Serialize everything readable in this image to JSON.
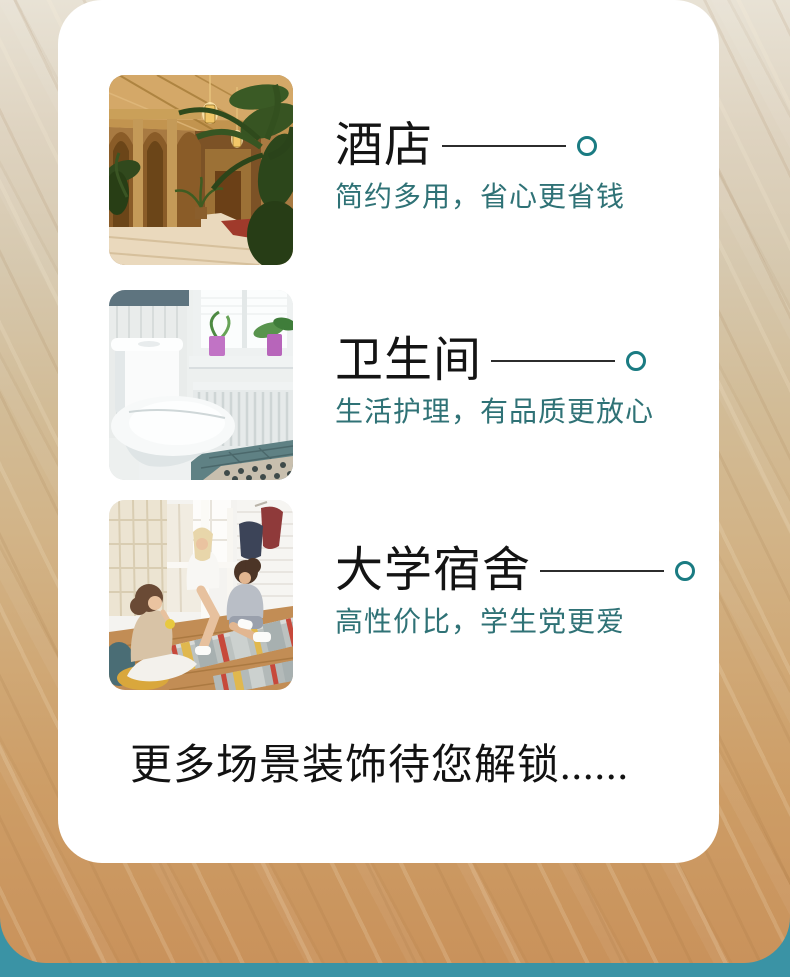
{
  "theme": {
    "accent_circle": "#1a7b82",
    "subtitle_color": "#2f7276",
    "rule_color": "#2c2c2c",
    "title_color": "#141414",
    "card_bg": "#ffffff",
    "bottom_bar_color": "#3a93a5",
    "wood_top": "#e8e2d5",
    "wood_bottom": "#c9925b"
  },
  "sections": [
    {
      "title": "酒店",
      "subtitle": "简约多用，省心更省钱",
      "photo": "hotel-lobby-photo"
    },
    {
      "title": "卫生间",
      "subtitle": "生活护理，有品质更放心",
      "photo": "bathroom-toilet-photo"
    },
    {
      "title": "大学宿舍",
      "subtitle": "高性价比，学生党更爱",
      "photo": "dorm-students-photo"
    }
  ],
  "footer": {
    "text": "更多场景装饰待您解锁......"
  }
}
